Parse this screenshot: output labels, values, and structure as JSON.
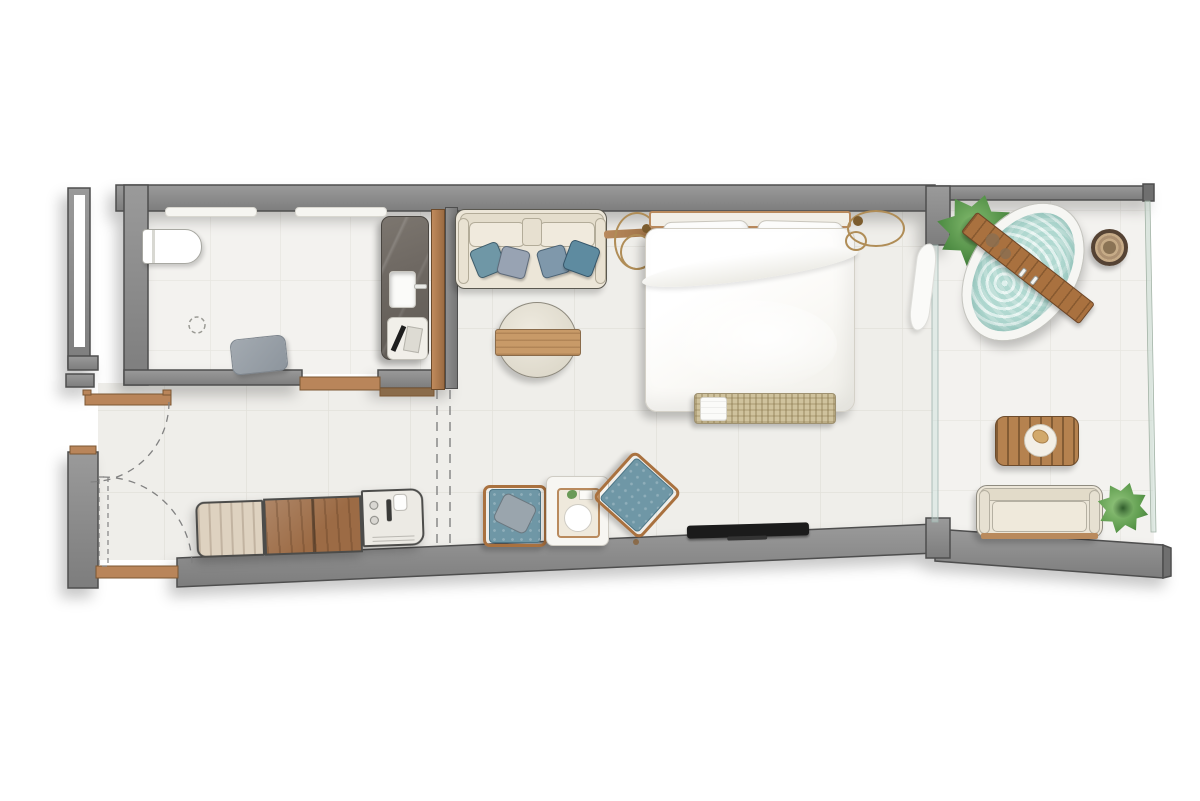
{
  "plan": {
    "type": "residential-floor-plan",
    "view": "top-down architectural render",
    "rooms": [
      {
        "id": "bathroom",
        "label": "Bathroom",
        "items": [
          "toilet",
          "shower-niches",
          "floor-drain",
          "bath-mat",
          "vanity-sink",
          "bathroom-tray"
        ]
      },
      {
        "id": "entry-hall",
        "label": "Entry Hall",
        "items": [
          "entry-door",
          "bathroom-door",
          "door-swing-arcs"
        ]
      },
      {
        "id": "kitchenette",
        "label": "Kitchenette",
        "items": [
          "cabinet",
          "wood-counter",
          "sink-hob-unit"
        ]
      },
      {
        "id": "living-area",
        "label": "Living Area",
        "items": [
          "sofa",
          "coffee-table",
          "armchair",
          "armchair-rotated",
          "side-table",
          "pendant-lamp"
        ]
      },
      {
        "id": "bedroom",
        "label": "Bedroom",
        "items": [
          "double-bed",
          "bed-bench",
          "pendant-lamp-left",
          "pendant-lamp-right",
          "tv",
          "curtain"
        ]
      },
      {
        "id": "terrace",
        "label": "Terrace",
        "items": [
          "plunge-pool",
          "bath-board",
          "potted-plant",
          "basket",
          "slatted-table",
          "outdoor-sofa",
          "glass-railing"
        ]
      }
    ]
  },
  "items": {
    "toilet": "Toilet",
    "shower_niche": "Shower niche shelf",
    "floor_drain": "Floor drain",
    "bath_mat": "Bath mat",
    "vanity": "Marble vanity with sink",
    "bath_tray": "Vanity tray with accessories",
    "wardrobe": "Wardrobe / sliding-door partition",
    "bathroom_door": "Bathroom door with swing arc",
    "entry_door": "Entry door with swing arc",
    "kitchen_cabinet": "Kitchen cabinet",
    "kitchen_counter": "Wood countertop",
    "kitchen_sink": "Sink and hob unit",
    "sofa": "Sofa with cushions",
    "pendant_left": "Brass pendant lamp",
    "pendant_right": "Brass pendant lamp",
    "coffee_table": "Round coffee table with wood plank",
    "armchair1": "Lounge armchair with pillow",
    "armchair2": "Lounge armchair (angled)",
    "side_table": "Side table with serving tray",
    "bed": "Double bed with headboard",
    "bench": "Rattan bed-end bench with towel",
    "tv": "Wall-mounted TV",
    "curtain": "Curtain at glass door",
    "plunge_pool": "Oval plunge pool",
    "pool_board": "Wooden bath board",
    "plant1": "Potted plant",
    "plant2": "Potted plant",
    "basket": "Round woven basket",
    "outdoor_table": "Slatted outdoor table",
    "outdoor_sofa": "Outdoor sofa",
    "railing": "Glass railing",
    "glass_partition": "Glass sliding door to terrace"
  },
  "colors": {
    "wall": "#8d8d8d",
    "wallEdge": "#4e4e4e",
    "floor": "#efeeea",
    "floorLine": "#e2e0da",
    "wood": "#b9855a",
    "woodDark": "#9c6b45",
    "woodDeep": "#7c5733",
    "cream": "#ece6d8",
    "water": "#b8ded7",
    "teal": "#6f97a6",
    "slate": "#98a3b3",
    "plant": "#4c8a42",
    "marble": "#6e6862",
    "linen": "#fcfcfb",
    "rattan": "#cfc29d"
  }
}
